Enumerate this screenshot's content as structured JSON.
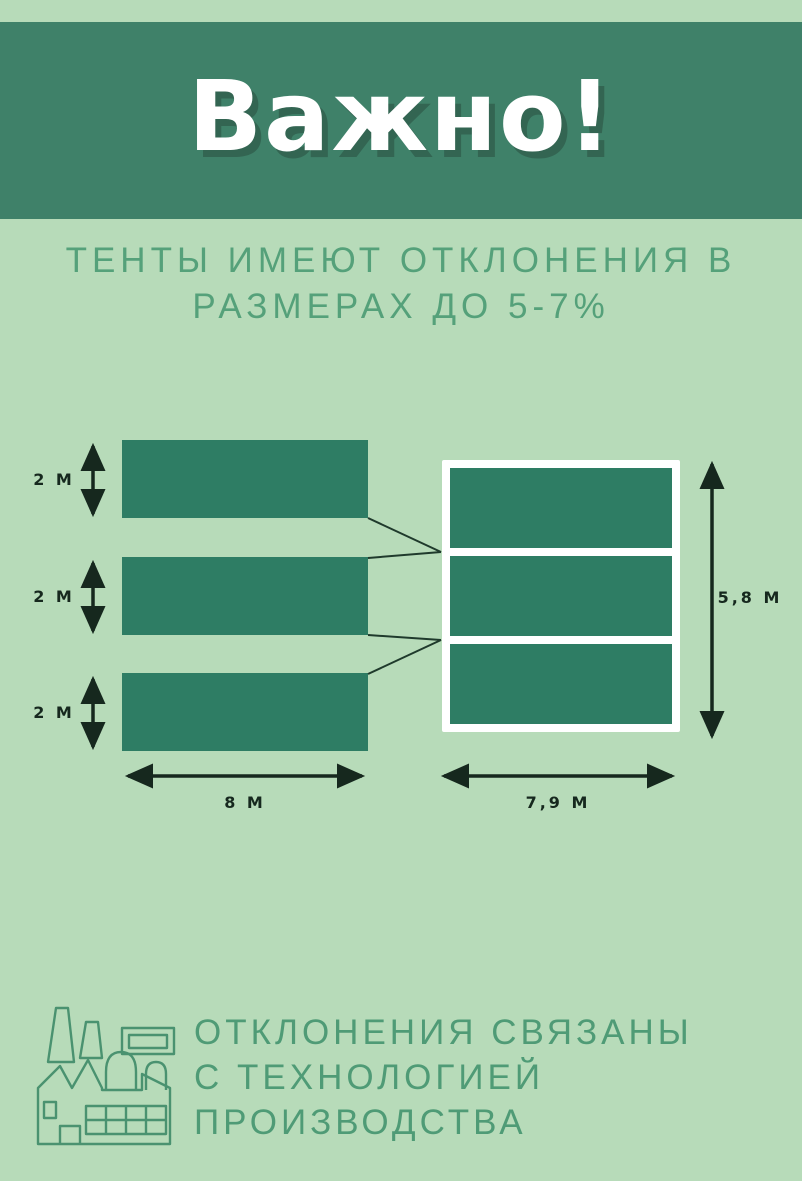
{
  "poster": {
    "background_color": "#b7dbb9",
    "header": {
      "title": "Важно!",
      "band_color": "#3f8169",
      "text_color": "#ffffff"
    },
    "subtitle": {
      "line1": "ТЕНТЫ ИМЕЮТ ОТКЛОНЕНИЯ В",
      "line2": "РАЗМЕРАХ ДО 5-7%",
      "color": "#55a17a"
    },
    "diagram": {
      "left_stack": {
        "panels": [
          {
            "height_label": "2 М"
          },
          {
            "height_label": "2 М"
          },
          {
            "height_label": "2 М"
          }
        ],
        "width_label": "8 М"
      },
      "assembled": {
        "sections": 3,
        "height_label": "5,8 М",
        "width_label": "7,9 М"
      },
      "panel_color": "#2e7d64",
      "frame_color": "#ffffff",
      "dimension_color": "#16281e",
      "connector_color": "#1f3a2c"
    },
    "footer": {
      "icon": "factory-icon",
      "line1": "ОТКЛОНЕНИЯ СВЯЗАНЫ",
      "line2": "С ТЕХНОЛОГИЕЙ",
      "line3": "ПРОИЗВОДСТВА",
      "color": "#4f9b76"
    }
  }
}
